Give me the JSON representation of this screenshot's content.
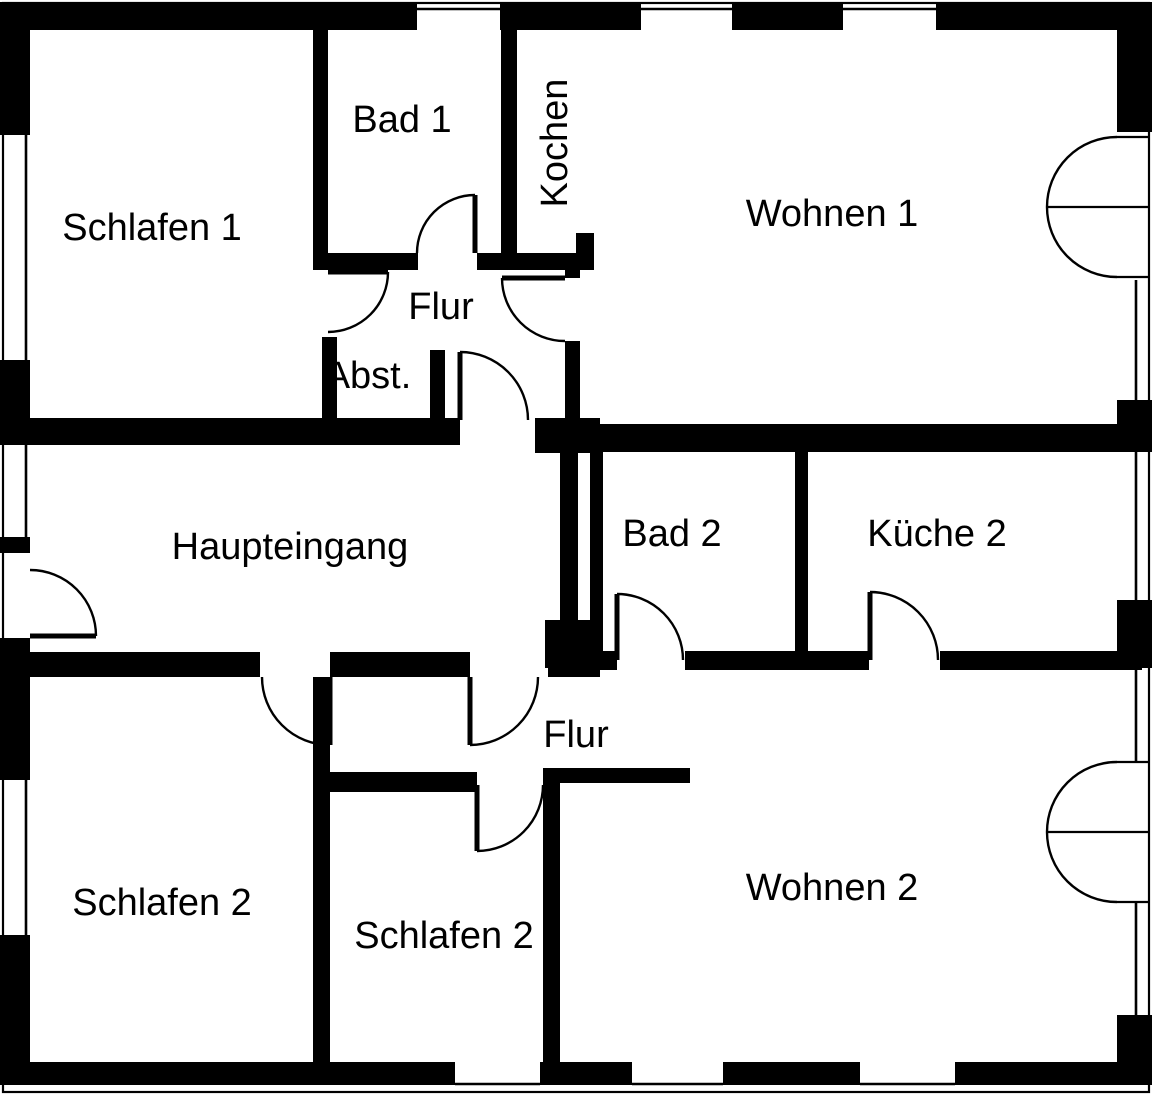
{
  "canvas": {
    "width": 1152,
    "height": 1095,
    "background_color": "#ffffff",
    "ink_color": "#000000"
  },
  "floor_plan": {
    "type": "apartment-floor-plan",
    "language": "German",
    "rooms": [
      {
        "id": "schlafen-1",
        "label": "Schlafen 1",
        "x": 152,
        "y": 228,
        "rotation": 0
      },
      {
        "id": "bad-1",
        "label": "Bad 1",
        "x": 402,
        "y": 120,
        "rotation": 0
      },
      {
        "id": "kochen",
        "label": "Kochen",
        "x": 555,
        "y": 143,
        "rotation": -90
      },
      {
        "id": "wohnen-1",
        "label": "Wohnen 1",
        "x": 832,
        "y": 214,
        "rotation": 0
      },
      {
        "id": "flur-oben",
        "label": "Flur",
        "x": 441,
        "y": 307,
        "rotation": 0
      },
      {
        "id": "abstellraum",
        "label": "Abst.",
        "x": 368,
        "y": 376,
        "rotation": 0
      },
      {
        "id": "haupteingang",
        "label": "Haupteingang",
        "x": 290,
        "y": 547,
        "rotation": 0
      },
      {
        "id": "bad-2",
        "label": "Bad 2",
        "x": 672,
        "y": 534,
        "rotation": 0
      },
      {
        "id": "kueche-2",
        "label": "Küche 2",
        "x": 937,
        "y": 534,
        "rotation": 0
      },
      {
        "id": "flur-unten",
        "label": "Flur",
        "x": 576,
        "y": 735,
        "rotation": 0
      },
      {
        "id": "schlafen-2-links",
        "label": "Schlafen 2",
        "x": 162,
        "y": 903,
        "rotation": 0
      },
      {
        "id": "schlafen-2-mitte",
        "label": "Schlafen 2",
        "x": 444,
        "y": 936,
        "rotation": 0
      },
      {
        "id": "wohnen-2",
        "label": "Wohnen 2",
        "x": 832,
        "y": 888,
        "rotation": 0
      }
    ],
    "swing_door_count": 10,
    "double_door_count": 2,
    "window_count": 13
  }
}
